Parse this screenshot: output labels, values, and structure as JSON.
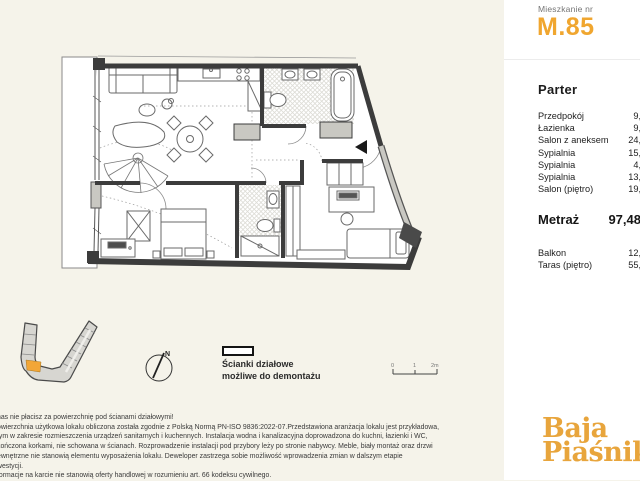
{
  "colors": {
    "background": "#F5F3EA",
    "sidebar": "#FFFFFF",
    "accent_amber": "#F0A62F",
    "logo_gold": "#E8A53C",
    "unit_highlight": "#F2A637",
    "wall": "#3C3C3C"
  },
  "sidebar": {
    "apartment_label": "Mieszkanie nr",
    "apartment_number": "M.85",
    "floor_heading": "Parter",
    "rooms": [
      {
        "label": "Przedpokój",
        "value": "9,"
      },
      {
        "label": "Łazienka",
        "value": "9,"
      },
      {
        "label": "Salon z aneksem",
        "value": "24,"
      },
      {
        "label": "Sypialnia",
        "value": "15,"
      },
      {
        "label": "Sypialnia",
        "value": "4,"
      },
      {
        "label": "Sypialnia",
        "value": "13,"
      },
      {
        "label": "Salon (piętro)",
        "value": "19,"
      }
    ],
    "metraz_label": "Metraż",
    "metraz_value": "97,48",
    "extras": [
      {
        "label": "Balkon",
        "value": "12,"
      },
      {
        "label": "Taras (piętro)",
        "value": "55,"
      }
    ],
    "logo_line1": "Baja",
    "logo_line2": "Piaśniki"
  },
  "plan": {
    "legend_line1": "Ścianki działowe",
    "legend_line2": "możliwe do demontażu",
    "compass_label": "N",
    "scale_ticks": [
      "0",
      "1",
      "2m"
    ]
  },
  "footnotes": [
    "nas nie płacisz za powierzchnię pod ścianami działowymi!",
    "owierzchnia użytkowa lokalu obliczona została zgodnie z Polską Normą PN-ISO 9836:2022-07.Przedstawiona aranżacja lokalu jest przykładowa,",
    "tym w zakresie rozmieszczenia urządzeń sanitarnych i kuchennych. Instalacja wodna i kanalizacyjna doprowadzona do kuchni, łazienki i WC,",
    "kończona korkami, nie schowana w ścianach. Rozprowadzenie instalacji pod przybory leży po stronie nabywcy. Meble, biały montaż oraz drzwi",
    "ewnętrzne nie stanowią elementu wyposażenia lokalu. Deweloper zastrzega sobie możliwość wprowadzenia zmian w dalszym etapie",
    "westycji.",
    "formacje na karcie nie stanowią oferty handlowej w rozumieniu art. 66 kodeksu cywilnego."
  ]
}
